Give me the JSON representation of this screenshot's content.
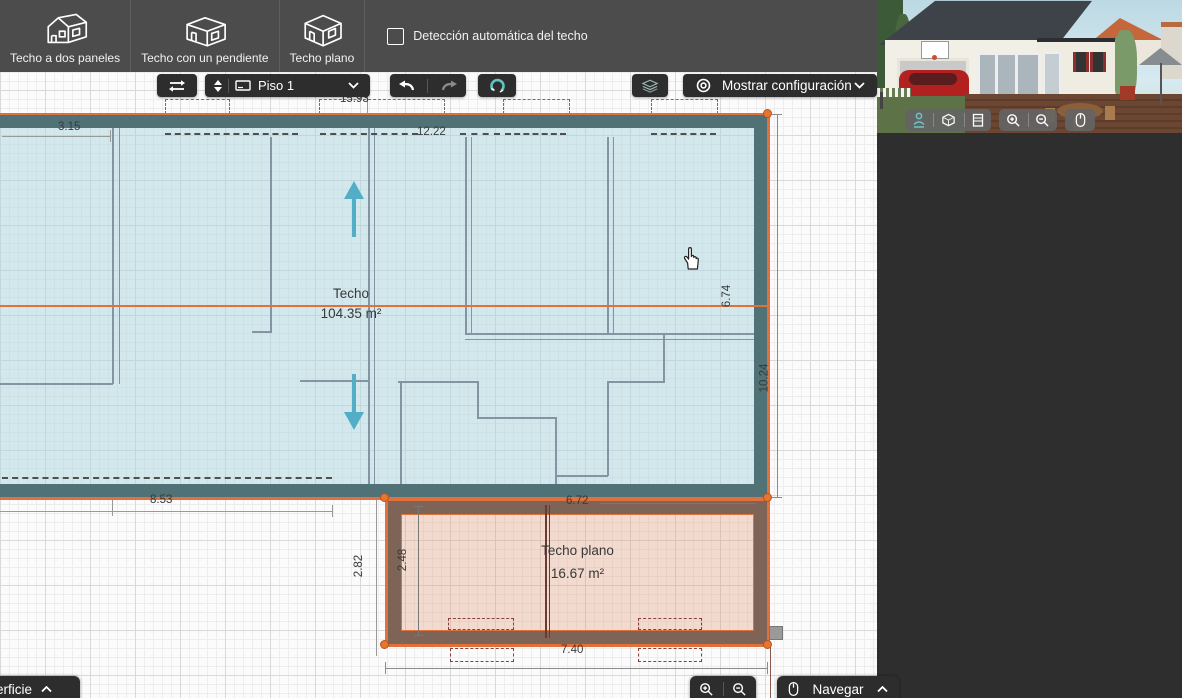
{
  "top_toolbar": {
    "buttons": [
      {
        "label": "Techo a dos paneles"
      },
      {
        "label": "Techo con un pendiente"
      },
      {
        "label": "Techo plano"
      }
    ],
    "auto_detect": {
      "label": "Detección automática del techo",
      "checked": false
    }
  },
  "canvas_toolbar": {
    "floor": {
      "label": "Piso 1"
    },
    "show_config": {
      "label": "Mostrar configuración"
    }
  },
  "plan": {
    "main_roof": {
      "label": "Techo",
      "area": "104.35 m²"
    },
    "flat_roof": {
      "label": "Techo plano",
      "area": "16.67 m²"
    },
    "dimensions": {
      "top_left": "3.15",
      "top": "15.93",
      "ridge": "12.22",
      "right_upper": "6.74",
      "right_lower": "10.24",
      "bottom_left": "8.53",
      "flat_left_outer": "2.82",
      "flat_left_inner": "2.48",
      "flat_top": "6.72",
      "flat_bottom": "7.40"
    }
  },
  "bottom_bar": {
    "surface": "Superficie",
    "navigate": "Navegar"
  },
  "icons": {
    "roof_buttons": [
      "gable-roof-house-icon",
      "single-slope-roof-house-icon",
      "flat-roof-house-icon"
    ]
  },
  "colors": {
    "selection_orange": "#e2703a",
    "roof_band_teal": "#507175",
    "roof_fill_teal": "#cfe8ec",
    "flat_band_brown": "#7d6456",
    "flat_fill_salmon": "#f2ded2",
    "slope_arrow_teal": "#52aec6"
  }
}
